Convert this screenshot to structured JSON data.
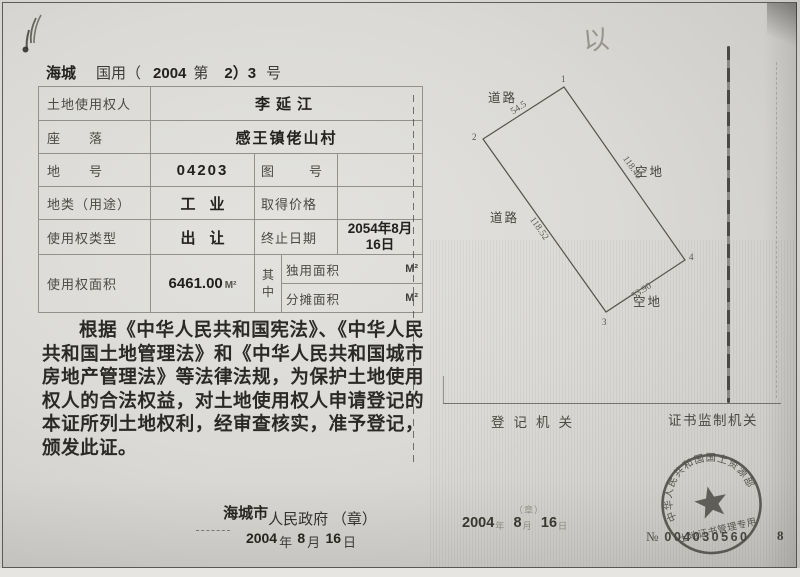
{
  "header": {
    "region": "海城",
    "type_label": "国用（",
    "year": "2004",
    "no_label": "第",
    "serial": "2）3",
    "hao_label": "号"
  },
  "table": {
    "holder_label": "土地使用权人",
    "holder_value": "李延江",
    "location_label": "座　　落",
    "location_value": "感王镇佬山村",
    "plot_no_label": "地　　号",
    "plot_no_value": "04203",
    "map_no_label": "图　　号",
    "use_type_label": "地类（用途）",
    "use_type_value": "工业",
    "price_label": "取得价格",
    "right_type_label": "使用权类型",
    "right_type_value": "出让",
    "end_date_label": "终止日期",
    "end_date_value": "2054年8月16日",
    "area_label": "使用权面积",
    "area_value": "6461.00",
    "area_unit": "M²",
    "qizhong_label": "其中",
    "exclusive_label": "独用面积",
    "exclusive_unit": "M²",
    "shared_label": "分摊面积",
    "shared_unit": "M²"
  },
  "body_text": "根据《中华人民共和国宪法》、《中华人民共和国土地管理法》和《中华人民共和国城市房地产管理法》等法律法规，为保护土地使用权人的合法权益，对土地使用权人申请登记的本证所列土地权利，经审查核实，准予登记，颁发此证。",
  "issuer": {
    "city": "海城市",
    "gov": "人民政府",
    "seal_note": "（章）",
    "year": "2004",
    "nian": "年",
    "month": "8",
    "yue": "月",
    "day": "16",
    "ri": "日"
  },
  "plot": {
    "road_top": "道路",
    "road_left": "道路",
    "vacant_right": "空地",
    "vacant_bottom": "空地",
    "len_top": "54.5",
    "len_right": "118.40",
    "len_left": "118.52",
    "len_bottom": "53.90",
    "corner_1": "1",
    "corner_2": "2",
    "corner_3": "3",
    "corner_4": "4"
  },
  "footer": {
    "registry_label": "登记机关",
    "supervisor_label": "证书监制机关",
    "seal_note": "（章）",
    "date_year": "2004",
    "date_nian": "年",
    "date_month": "8",
    "date_yue": "月",
    "date_day": "16",
    "date_ri": "日",
    "serial_prefix": "№",
    "serial_no": "004030560",
    "page_no": "8"
  },
  "seal": {
    "ring_text": "中华人民共和国国土资源部",
    "bottom_text": "土地证书管理专用"
  },
  "annotations": {
    "handwritten_mark": "以"
  }
}
